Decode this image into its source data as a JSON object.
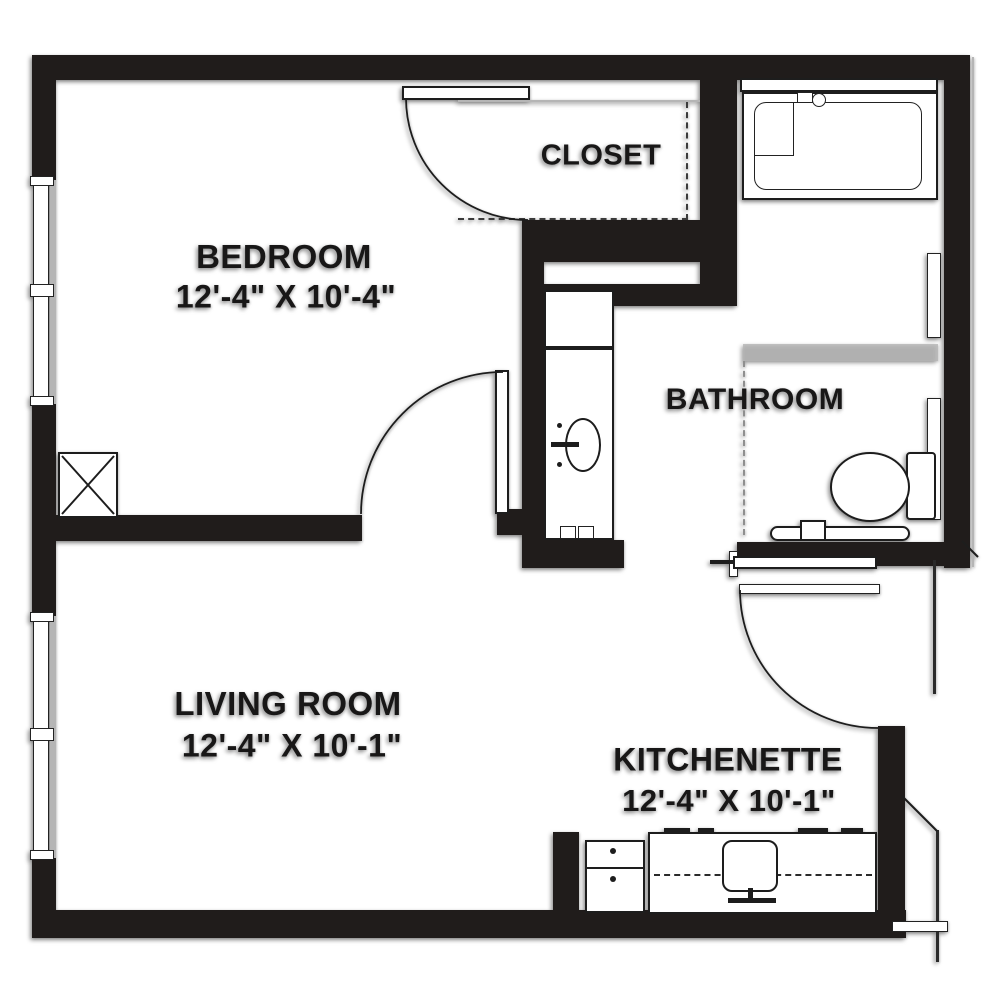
{
  "title": "One-bedroom apartment floor plan",
  "rooms": {
    "bedroom": {
      "name": "BEDROOM",
      "dimensions": "12'-4\" X 10'-4\""
    },
    "closet": {
      "name": "CLOSET",
      "dimensions": ""
    },
    "bathroom": {
      "name": "BATHROOM",
      "dimensions": ""
    },
    "living_room": {
      "name": "LIVING ROOM",
      "dimensions": "12'-4\" X 10'-1\""
    },
    "kitchenette": {
      "name": "KITCHENETTE",
      "dimensions": "12'-4\" X 10'-1\""
    }
  },
  "fixtures": [
    "bathtub",
    "toilet",
    "vanity-sink",
    "grab-bar",
    "kitchen-sink",
    "stove",
    "shaft-x-box",
    "bedroom-door",
    "closet-door",
    "bathroom-entry-door",
    "windows"
  ],
  "colors": {
    "wall": "#201c1b",
    "line": "#1d1d1d",
    "shadow_gray": "#b5b5b5",
    "background": "#ffffff"
  }
}
